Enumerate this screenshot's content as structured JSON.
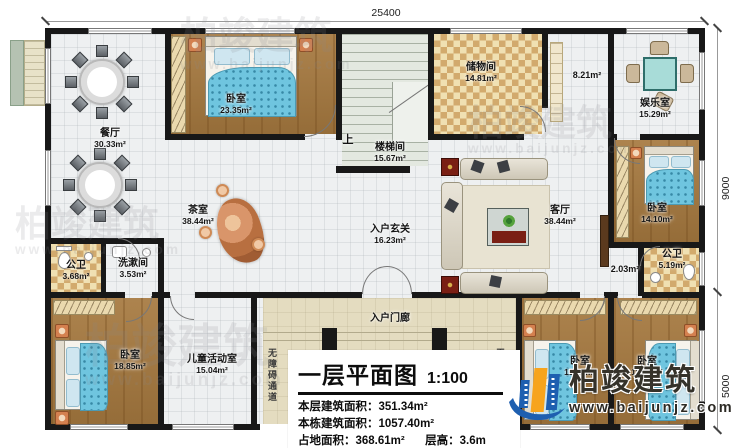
{
  "plan": {
    "title": "一层平面图",
    "scale": "1:100",
    "stats": {
      "line1_label": "本层建筑面积：",
      "line1_value": "351.34m²",
      "line2_label": "本栋建筑面积：",
      "line2_value": "1057.40m²",
      "line3_label": "占地面积：",
      "line3_value": "368.61m²",
      "line4_label": "层高：",
      "line4_value": "3.6m"
    }
  },
  "dimensions": {
    "top": "25400",
    "right_upper": "9000",
    "right_lower": "5000"
  },
  "stairs": {
    "up_label": "上"
  },
  "rooms": {
    "dining": {
      "name": "餐厅",
      "area": "30.33m²"
    },
    "bedroom_top": {
      "name": "卧室",
      "area": "23.35m²"
    },
    "stairwell": {
      "name": "楼梯间",
      "area": "15.67m²"
    },
    "storage": {
      "name": "储物间",
      "area": "14.81m²"
    },
    "hall": {
      "area": "8.21m²"
    },
    "entertainment": {
      "name": "娱乐室",
      "area": "15.29m²"
    },
    "bedroom_right": {
      "name": "卧室",
      "area": "14.10m²"
    },
    "bath_right": {
      "name": "公卫",
      "area": "5.19m²"
    },
    "nook": {
      "area": "2.03m²"
    },
    "living": {
      "name": "客厅",
      "area": "38.44m²"
    },
    "tea": {
      "name": "茶室",
      "area": "38.44m²"
    },
    "foyer": {
      "name": "入户玄关",
      "area": "16.23m²"
    },
    "bath_left": {
      "name": "公卫",
      "area": "3.68m²"
    },
    "wash": {
      "name": "洗漱间",
      "area": "3.53m²"
    },
    "bedroom_bl": {
      "name": "卧室",
      "area": "18.85m²"
    },
    "kids": {
      "name": "儿童活动室",
      "area": "15.04m²"
    },
    "porch": {
      "name": "入户门廊"
    },
    "ramp": {
      "name": "无障碍通道"
    },
    "bedroom_bm": {
      "name": "卧室",
      "area": "15.04m²"
    },
    "bedroom_br": {
      "name": "卧室",
      "area": "18.85m²"
    }
  },
  "watermark": {
    "brand": "柏竣建筑",
    "url": "www.baijunjz.com"
  },
  "logo": {
    "brand": "柏竣建筑",
    "url": "www.baijunjz.com"
  },
  "colors": {
    "wall": "#181818",
    "wood_floor": "#a6793f",
    "tile_check": "#d2aa6d",
    "porch_tan": "#e4dcc0",
    "blanket_blue": "#6fc5df",
    "logo_blue": "#1e5fb0",
    "logo_orange": "#f7a41d"
  }
}
